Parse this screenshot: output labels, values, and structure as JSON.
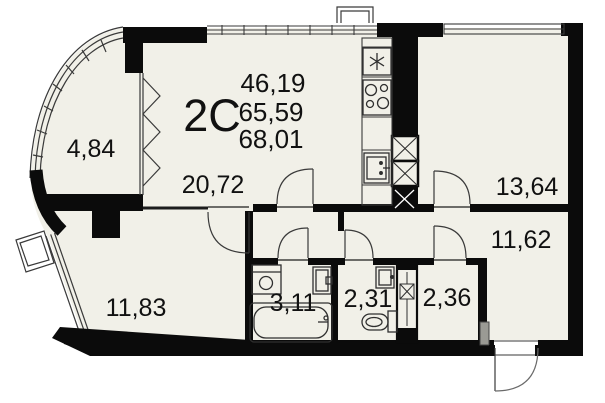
{
  "plan": {
    "type_label": "2C",
    "stacked_values": [
      "46,19",
      "65,59",
      "68,01"
    ]
  },
  "rooms": [
    {
      "id": "balcony",
      "area": "4,84"
    },
    {
      "id": "living-kitchen",
      "area": "20,72"
    },
    {
      "id": "room-top-right",
      "area": "13,64"
    },
    {
      "id": "hallway",
      "area": "11,62"
    },
    {
      "id": "room-bottom-left",
      "area": "11,83"
    },
    {
      "id": "bathroom",
      "area": "3,11"
    },
    {
      "id": "wc",
      "area": "2,31"
    },
    {
      "id": "storage",
      "area": "2,36"
    }
  ],
  "fixtures": [
    "fridge",
    "stove",
    "kitchen-sink",
    "vent-shaft",
    "bathtub",
    "washing-machine",
    "bathroom-sink",
    "wc-sink",
    "toilet",
    "vent-shaft-small",
    "entrance-door",
    "ac-basket"
  ],
  "colors": {
    "wall": "#0b0b0b",
    "floor": "#f1f0e8",
    "line": "#2f2f2f",
    "outside": "#ffffff"
  }
}
